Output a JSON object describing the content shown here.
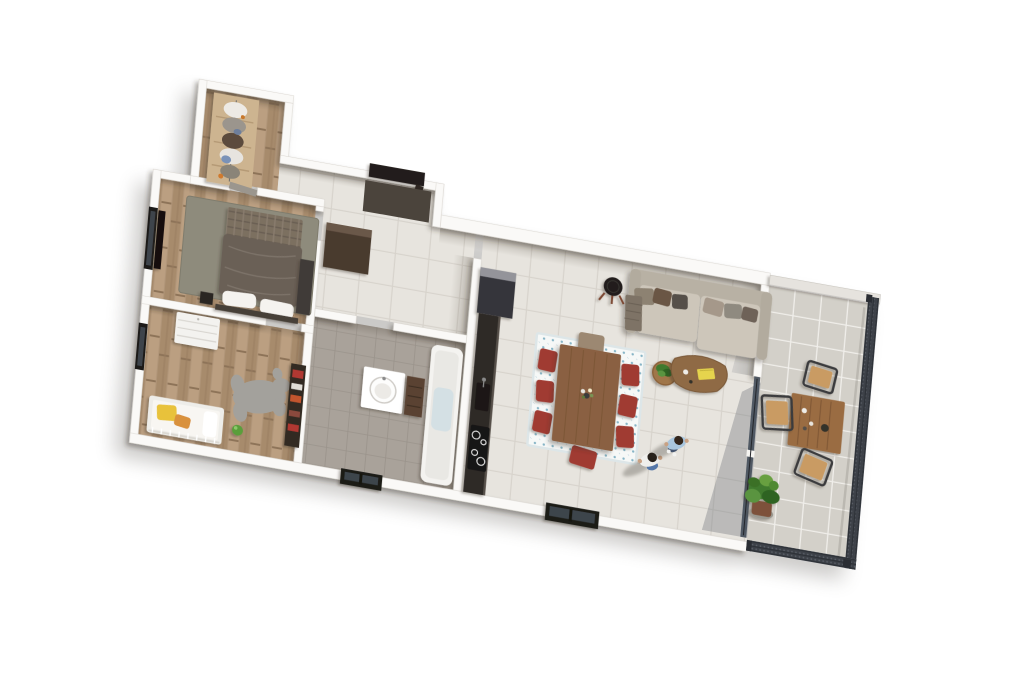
{
  "scene": {
    "kind": "3d-apartment-floor-plan-render",
    "view": "top-down isometric, plan rotated ~10 degrees, white background",
    "background": "#ffffff"
  },
  "palette": {
    "wall": "#faf9f7",
    "wall_edge": "#d8d4ce",
    "parapet": "#e6e3de",
    "tile_floor": "#e7e4de",
    "tile_line": "#d7d3cc",
    "terrace_floor": "#d3d0c9",
    "terrace_line": "#bfbcb5",
    "wood_floor": "#b09578",
    "bath_floor": "#a9a29a",
    "counter": "#2f2b27",
    "fridge": "#35353a",
    "fridge_top": "#94949a",
    "sofa": "#cdc6ba",
    "sofa_back": "#b8b1a4",
    "rug_master": "#8e8b7c",
    "rug_dining": "#f6f8f7",
    "rug_dining_dot": "#86b4c6",
    "chair_red": "#a03a32",
    "chair_head": "#9c8872",
    "dining_table": "#8a6143",
    "coffee_table": "#8f6a45",
    "side_table": "#a07648",
    "terrace_table": "#9a6c42",
    "terrace_chair": "#c99b63",
    "terrace_chair_frame": "#3a3b3c",
    "railing": "#3d4148",
    "railing_frame": "#2e3238",
    "glass": "#46505c",
    "plant_dark": "#2f6322",
    "plant": "#3f7a2e",
    "plant_light": "#5a9440",
    "pot_terracotta": "#7d513a",
    "entry_door": "#241f1a",
    "door_leaf": "#2e2822",
    "doormat": "#4b443c",
    "hall_closet": "#4a3a2e",
    "bed_duvet": "#6a6057",
    "bed_plaid": "#7b6f61",
    "headboard": "#473f37",
    "pillow": "#f5f3ef",
    "master_wardrobe": "#3f3b38",
    "tv_black": "#121110",
    "bear_rug": "#a3a19c",
    "kids_dresser": "#f3f2ef",
    "kids_shelf": "#332b24",
    "crib_frame": "#eeede9",
    "bedding_yellow": "#e8c23a",
    "bedding_orange": "#d9913c",
    "ball_green": "#5a9e3a",
    "bathtub": "#f4f3f0",
    "tub_water": "#c3d8e4",
    "basin": "#ffffff",
    "bath_cabinet": "#5a4232",
    "window_frame": "#1c1a18",
    "window_glass": "#3e444b",
    "stool_black": "#211f1d",
    "stool_legs": "#7c4630",
    "book_yellow": "#e6d44e",
    "shirt_white": "#f0efec",
    "shirt_blue": "#a9c6de",
    "jeans": "#5577a8",
    "jeans_dark": "#44546e",
    "skin": "#c9a183",
    "throw_plaid": "#7e7366",
    "wardrobe_wood": "#cdb490",
    "ground_shadow": "#4a453d"
  },
  "rooms": [
    {
      "name": "dressing",
      "floor": "wood planks"
    },
    {
      "name": "entry",
      "floor": "light tile"
    },
    {
      "name": "hallway",
      "floor": "light tile"
    },
    {
      "name": "master-bedroom",
      "floor": "wood planks"
    },
    {
      "name": "kids-bedroom",
      "floor": "wood planks"
    },
    {
      "name": "bathroom",
      "floor": "taupe tile"
    },
    {
      "name": "open-kitchen",
      "floor": "light tile"
    },
    {
      "name": "living-dining-room",
      "floor": "light tile"
    },
    {
      "name": "terrace",
      "floor": "grey outdoor tile"
    }
  ],
  "furniture": {
    "dressing": [
      "open wardrobe with hanging clothes"
    ],
    "entry": [
      "dark entrance door",
      "dark doormat"
    ],
    "hallway": [
      "dark brown closet"
    ],
    "master-bedroom": [
      "double bed with grey duvet and plaid throw",
      "white pillows",
      "grey-green rug",
      "wall TV",
      "dark wardrobe",
      "black bedside table",
      "window"
    ],
    "kids-bedroom": [
      "white cot with yellow-orange bedding",
      "white dresser",
      "animal-shaped grey rug",
      "green ball",
      "dark bookshelf with red books",
      "window"
    ],
    "bathroom": [
      "round washbasin on white counter",
      "brown storage cabinet",
      "bathtub",
      "window"
    ],
    "open-kitchen": [
      "tall dark cabinet-fridge",
      "dark worktop",
      "sink",
      "induction cooktop"
    ],
    "living-dining-room": [
      "wooden dining table",
      "six red chairs",
      "grey head chair",
      "blue patterned rug",
      "flower vase",
      "beige sofa with cushions",
      "plaid throw",
      "black stool",
      "round side table with plant",
      "triangular wooden coffee table",
      "yellow book",
      "glass sliding door",
      "window"
    ],
    "terrace": [
      "wooden outdoor table",
      "three wooden chairs",
      "large potted plant",
      "metal mesh railing",
      "glass-top parapet"
    ]
  },
  "people": [
    {
      "id": "person-1",
      "description": "standing person, white t-shirt, blue jeans, dark hair"
    },
    {
      "id": "person-2",
      "description": "standing person, light blue denim shirt, dark jeans, white sneakers"
    }
  ]
}
